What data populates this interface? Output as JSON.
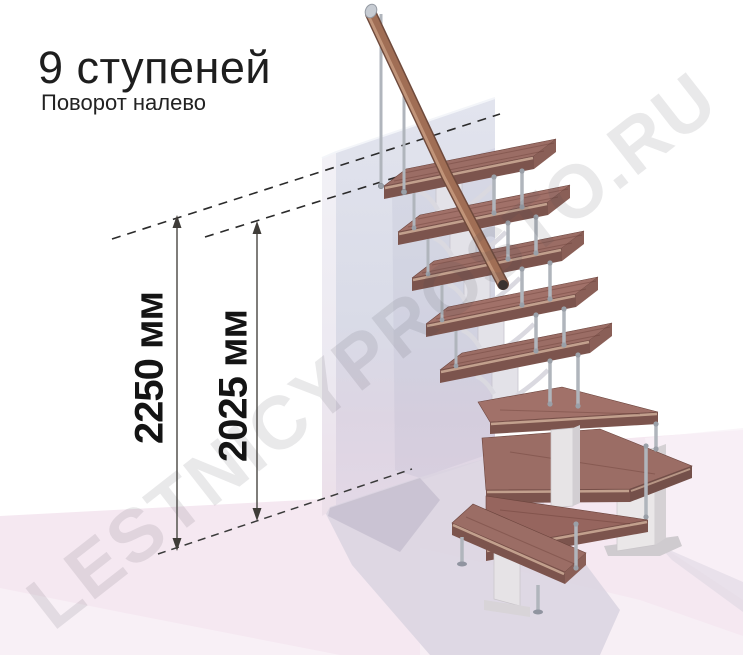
{
  "header": {
    "title": "9 ступеней",
    "subtitle": "Поворот налево"
  },
  "annotation": {
    "dimensions": [
      {
        "id": "total-height",
        "label": "2250 мм"
      },
      {
        "id": "upper-step-height",
        "label": "2025 мм"
      }
    ]
  },
  "watermark": {
    "text": "LESTNICYPROSTO.RU"
  },
  "stairs": {
    "steps_count": "9",
    "turn": "налево"
  },
  "colors": {
    "tread_top": "#9b6d65",
    "tread_front": "#7c544d",
    "handrail": "#a06e55",
    "baluster": "#b0b5bc",
    "spine": "#e3e2e8",
    "wall": "#dcdde8",
    "floor": "#f5e8f1",
    "shadow": "#d9d4e0",
    "dimension_line": "#2b2b2b"
  }
}
